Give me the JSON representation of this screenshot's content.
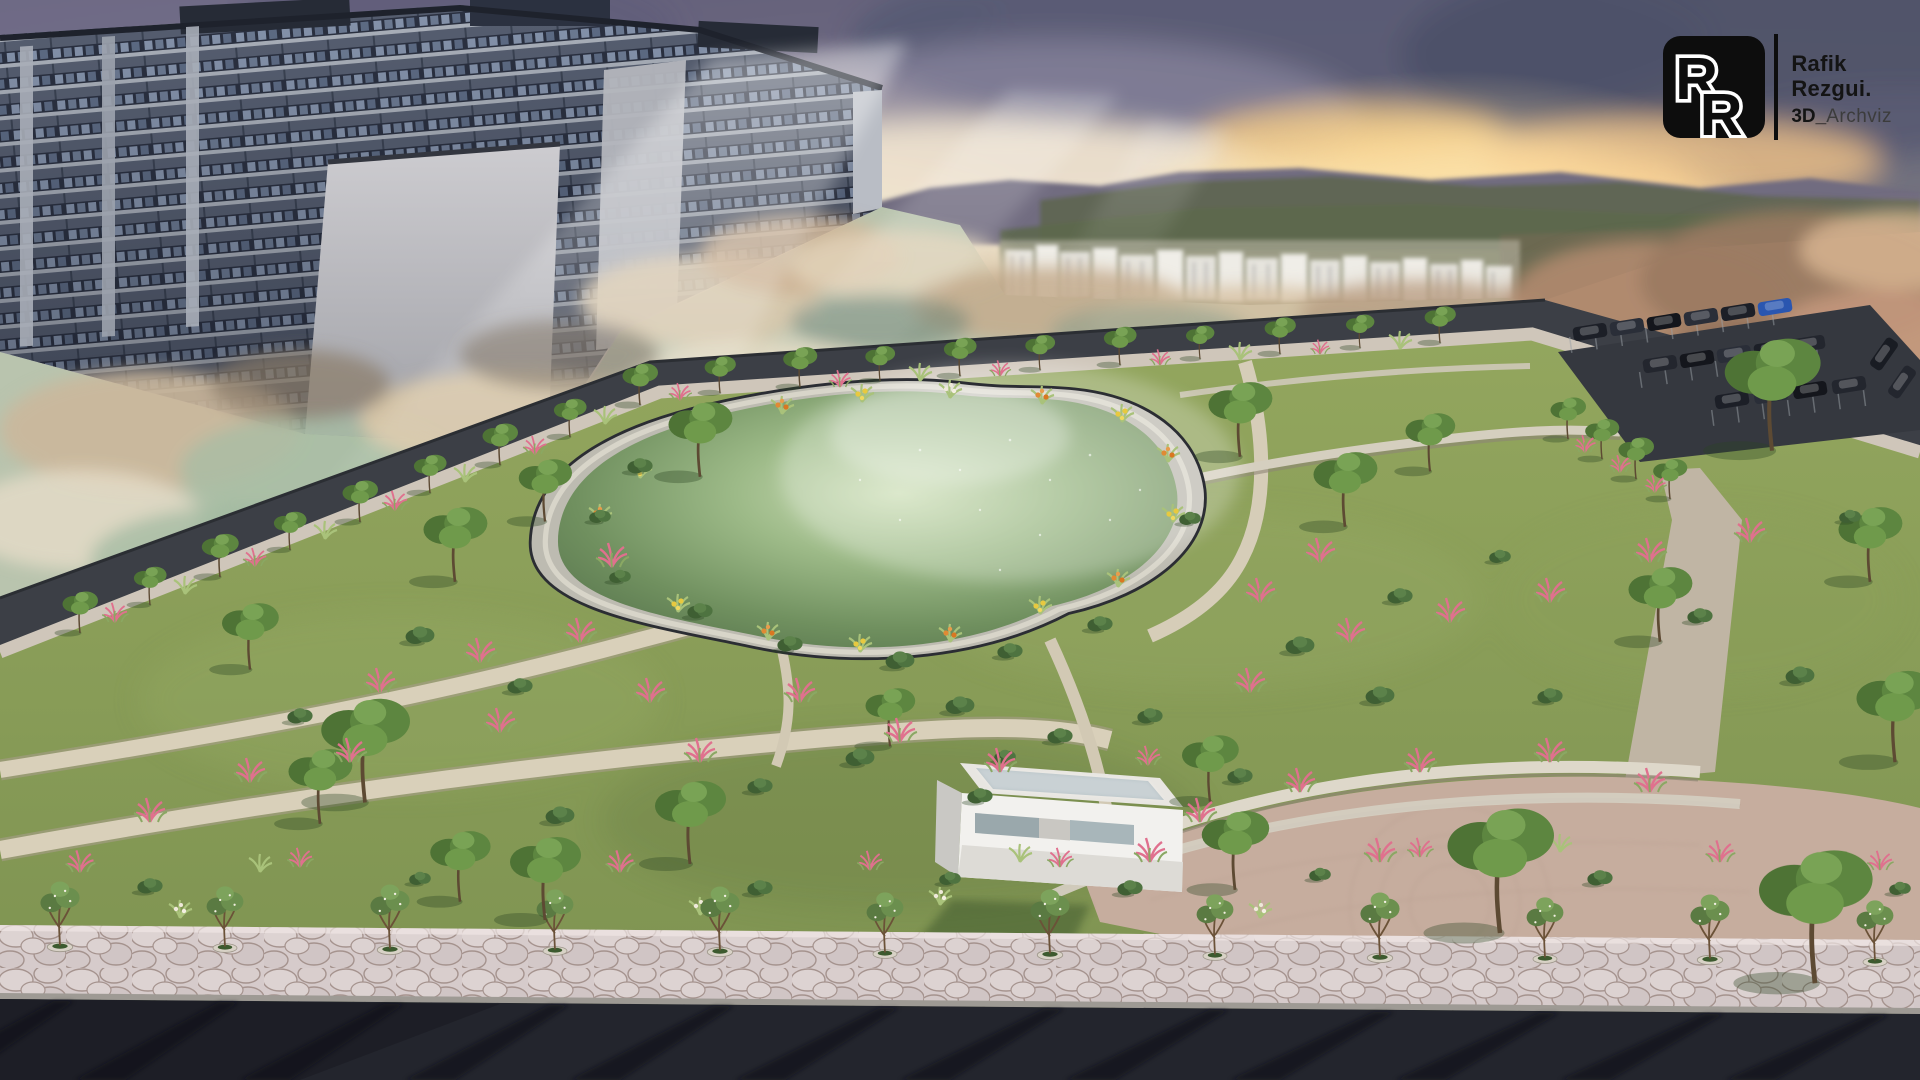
{
  "logo": {
    "mono1": "R",
    "mono2": "R",
    "line1": "Rafik",
    "line2": "Rezgui.",
    "line3_bold": "3D_",
    "line3_light": "Archviz"
  },
  "palette": {
    "sky_gold": "#f3d79b",
    "sky_slate": "#8a87a0",
    "cloud_dark": "#565a74",
    "water_green": "#6e8f63",
    "lawn_green": "#86985a",
    "asphalt_dark": "#23252d",
    "park_path": "#d9d0ba",
    "plaza_pink": "#c6ad9e",
    "sidewalk_flagstone": "#d6cbcb",
    "building_concrete": "#b9bdc5",
    "building_glass": "#3a4252",
    "flower_pink": "#e0708e",
    "flower_yellow": "#e8c93f",
    "flower_orange": "#e08a34",
    "car_blue": "#2a56b0",
    "logo_black": "#0d0d0d"
  }
}
